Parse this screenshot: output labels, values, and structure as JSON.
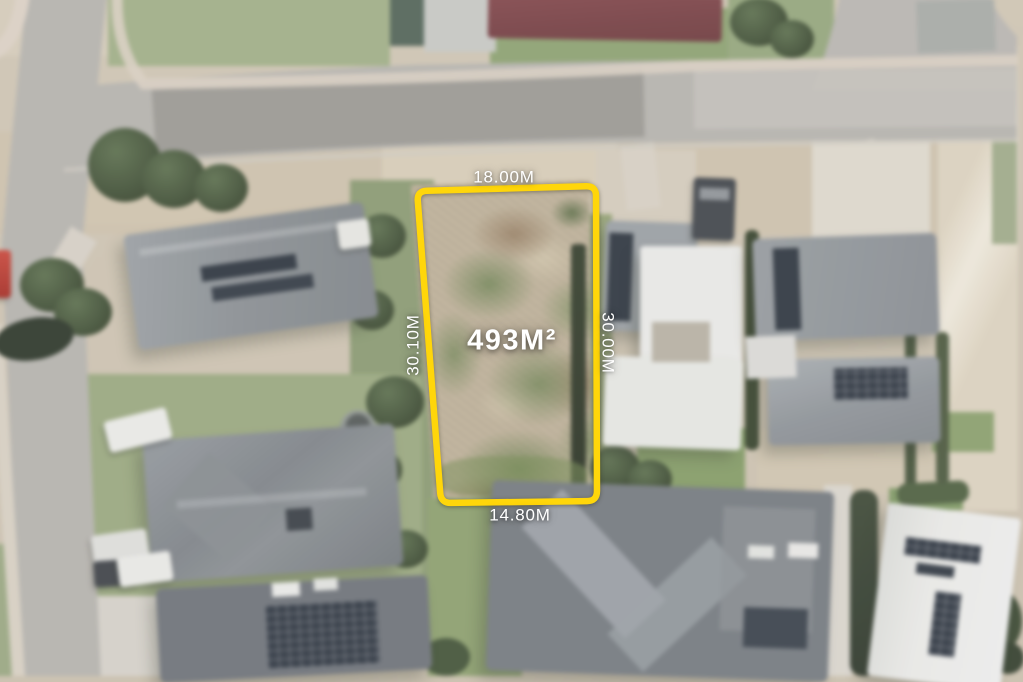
{
  "annotation": {
    "area": "493M²",
    "dimensions": {
      "top": "18.00M",
      "left": "30.10M",
      "right": "30.00M",
      "bottom": "14.80M"
    },
    "boundary_color": "#FFD60A",
    "label_color": "#FFFFFF"
  }
}
